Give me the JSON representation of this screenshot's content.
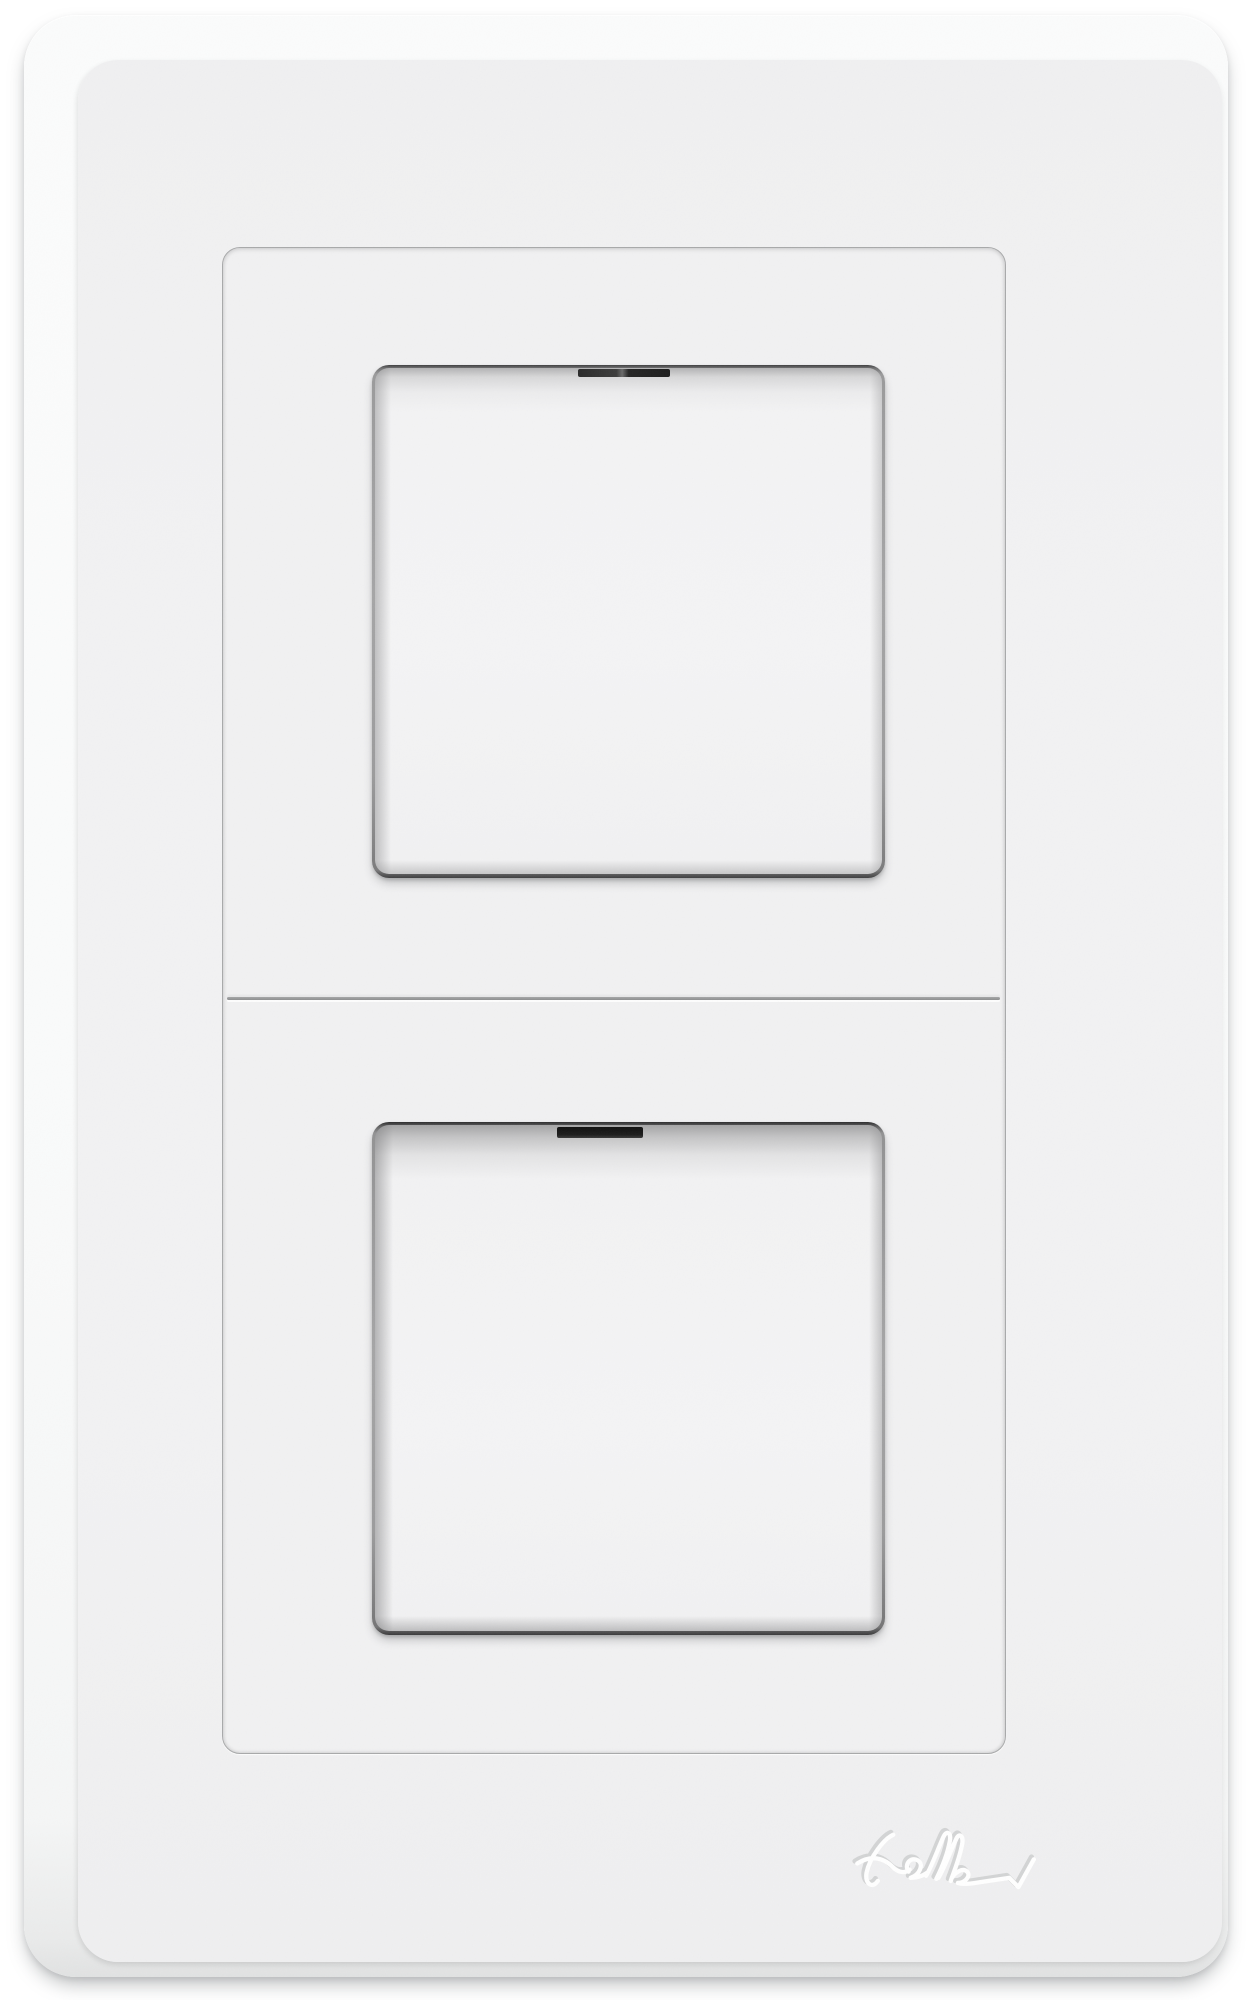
{
  "device": {
    "type": "wall-switch-plate",
    "brand": "Feller",
    "orientation": "vertical-2-gang",
    "modules": [
      {
        "position": "top",
        "kind": "rocker-switch"
      },
      {
        "position": "bottom",
        "kind": "rocker-switch"
      }
    ],
    "logo": {
      "text": "Feller",
      "style": "embossed-signature",
      "position": "bottom-right"
    },
    "colors": {
      "background": "#ffffff",
      "plate_rim": "#fbfcfc",
      "plate_face": "#f2f2f3",
      "plate_bottom_edge": "#e1e2e2",
      "frame_groove": "#a8a9aa",
      "rocker_face": "#f3f3f4",
      "rocker_gap_dark": "#3e3e3f",
      "rocker_slot": "#161616",
      "logo_emboss": "#ffffff",
      "logo_shadow": "#d3d4d5"
    }
  }
}
